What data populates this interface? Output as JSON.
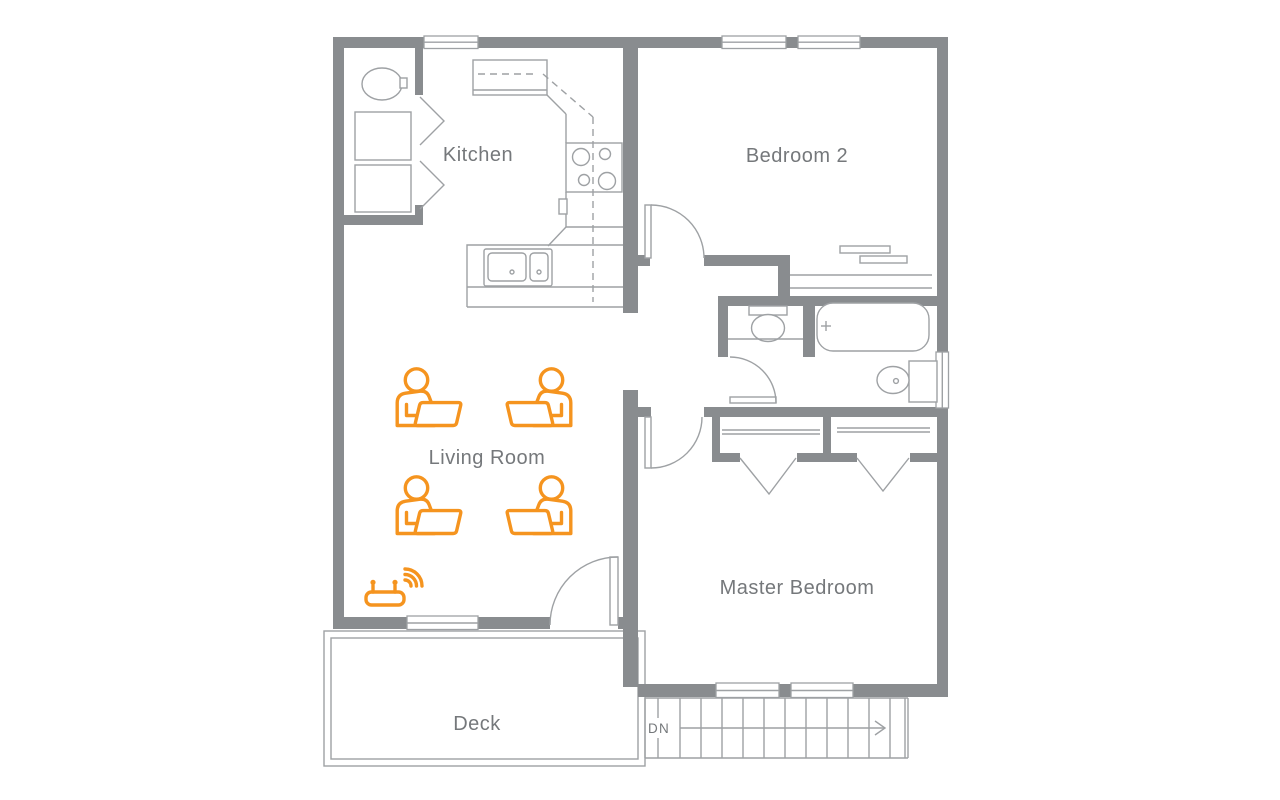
{
  "floor_plan": {
    "rooms": [
      {
        "id": "kitchen",
        "label": "Kitchen"
      },
      {
        "id": "bedroom2",
        "label": "Bedroom 2"
      },
      {
        "id": "living_room",
        "label": "Living Room"
      },
      {
        "id": "master_bedroom",
        "label": "Master Bedroom"
      },
      {
        "id": "deck",
        "label": "Deck"
      }
    ],
    "stairs": {
      "label": "DN"
    },
    "icons": {
      "person_with_laptop_count": 4,
      "wifi_router_count": 1
    },
    "colors": {
      "wall": "#898C8F",
      "thin_line": "#9EA1A4",
      "label_text": "#75787B",
      "accent_orange": "#F5941F",
      "background": "#FFFFFF"
    }
  }
}
